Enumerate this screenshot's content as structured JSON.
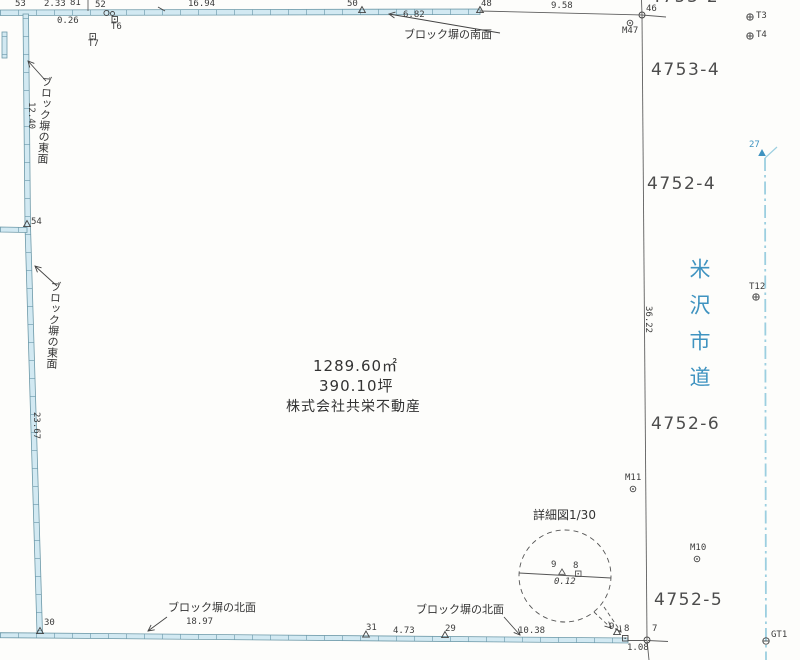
{
  "site": {
    "area_m2": "1289.60㎡",
    "area_tsubo": "390.10坪",
    "owner": "株式会社共栄不動産"
  },
  "parcels": {
    "top_partial": "4753-2",
    "ne": "4753-4",
    "east_upper": "4752-4",
    "east_mid": "4752-6",
    "east_lower": "4752-5"
  },
  "road": {
    "name": "米沢市道"
  },
  "wall_labels": {
    "south": "ブロック塀の南面",
    "east": "ブロック塀の東面",
    "north": "ブロック塀の北面"
  },
  "detail_view": {
    "title": "詳細図1/30",
    "point_9": "9",
    "point_8": "8",
    "dist_9_8": "0.12"
  },
  "dimensions": {
    "top_53_81": "2.33",
    "top_offset": "0.26",
    "top_52_50": "16.94",
    "top_50_48": "6.82",
    "top_48_46": "9.58",
    "left_upper": "12.40",
    "left_lower": "23.67",
    "right_side": "36.22",
    "bottom_30_31": "18.97",
    "bottom_31_29": "4.73",
    "bottom_29_9": "10.38",
    "bottom_8_7": "1.08"
  },
  "points": {
    "p53": "53",
    "p81": "81",
    "p52": "52",
    "p50": "50",
    "p48": "48",
    "p46": "46",
    "p54": "54",
    "p30": "30",
    "p31": "31",
    "p29": "29",
    "p9": "9",
    "p8": "8",
    "p7": "7",
    "p27": "27"
  },
  "stations": {
    "t3": "T3",
    "t4": "T4",
    "t6": "T6",
    "t7": "T7",
    "t12": "T12",
    "m47": "M47",
    "m11": "M11",
    "m10": "M10",
    "gt1": "GT1"
  },
  "colors": {
    "wall_fill": "#d2e9f2",
    "wall_edge": "#6d99a8",
    "road_text": "#3f93c0",
    "road_line": "#9ccfe0",
    "line": "#5f5f5f",
    "text": "#3c3c3c"
  }
}
